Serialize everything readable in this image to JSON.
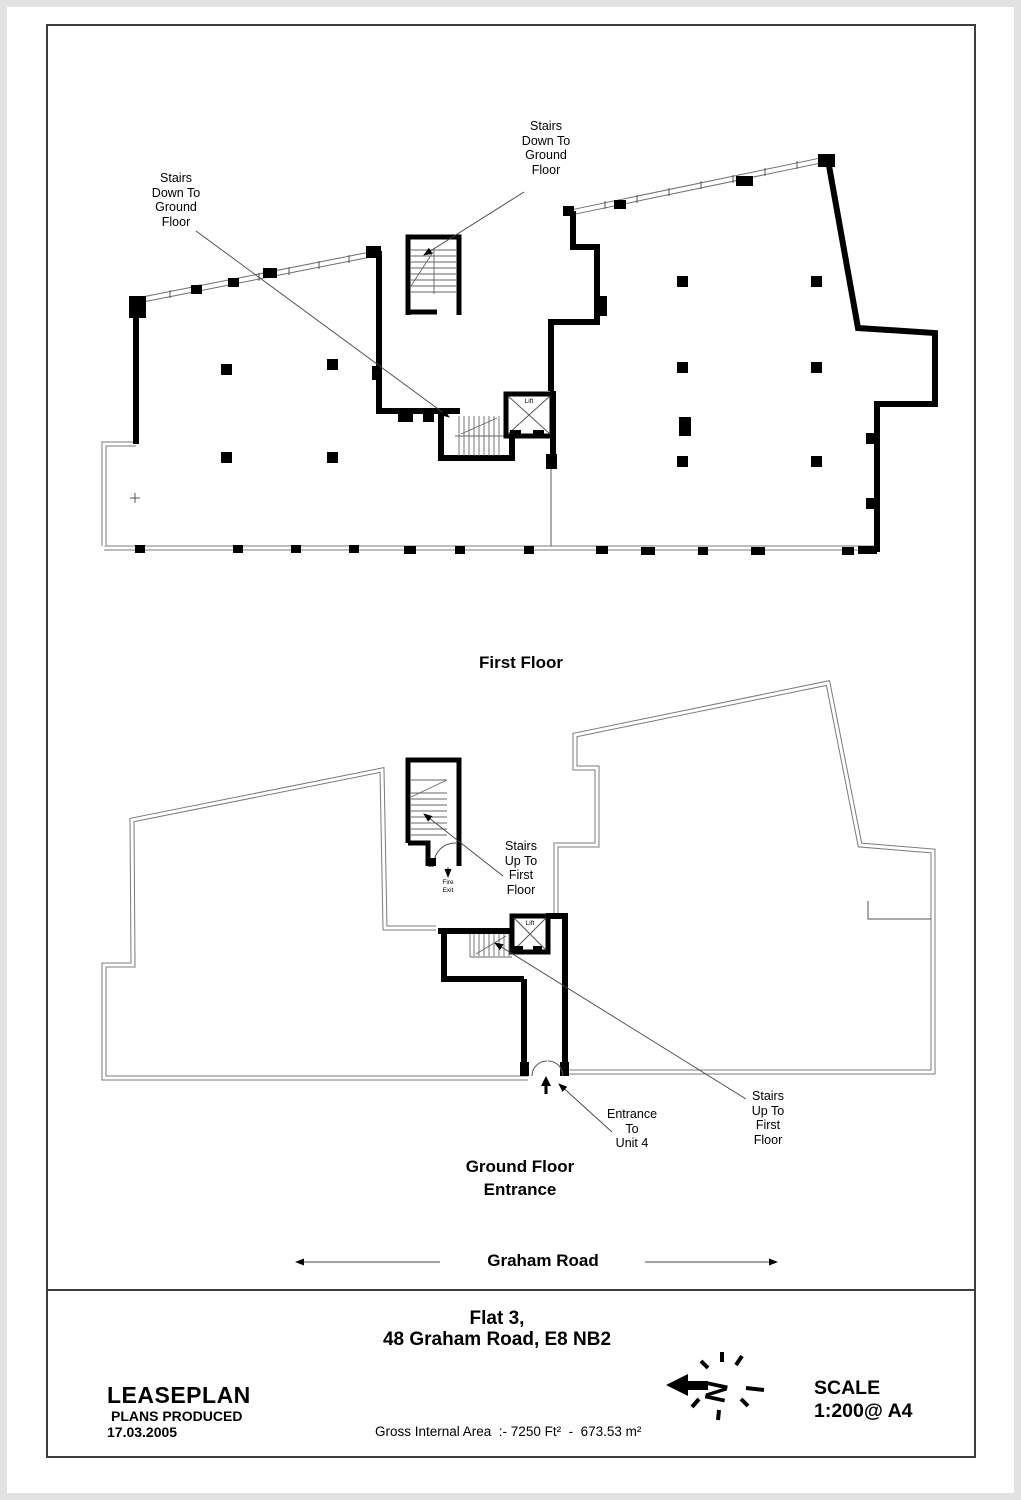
{
  "sheet": {
    "title_line1": "Flat 3,",
    "title_line2": "48 Graham Road, E8 NB2"
  },
  "first_floor": {
    "caption": "First Floor",
    "stairs_label_left": "Stairs\nDown To\nGround\nFloor",
    "stairs_label_top": "Stairs\nDown To\nGround\nFloor",
    "lift_label": "Lift"
  },
  "ground_floor": {
    "caption": "Ground Floor\nEntrance",
    "stairs_label_upper": "Stairs\nUp To\nFirst\nFloor",
    "stairs_label_lower": "Stairs\nUp To\nFirst\nFloor",
    "entrance_label": "Entrance\nTo\nUnit 4",
    "fire_exit_label": "Fire\nExit",
    "lift_label": "Lift",
    "street_name": "Graham Road"
  },
  "footer": {
    "brand": "LEASEPLAN",
    "produced_label": "PLANS PRODUCED",
    "produced_date": "17.03.2005",
    "area_text": "Gross Internal Area  :- 7250 Ft²  -  673.53 m²",
    "scale_label": "SCALE",
    "scale_value": "1:200@ A4",
    "north_letter": "N"
  }
}
